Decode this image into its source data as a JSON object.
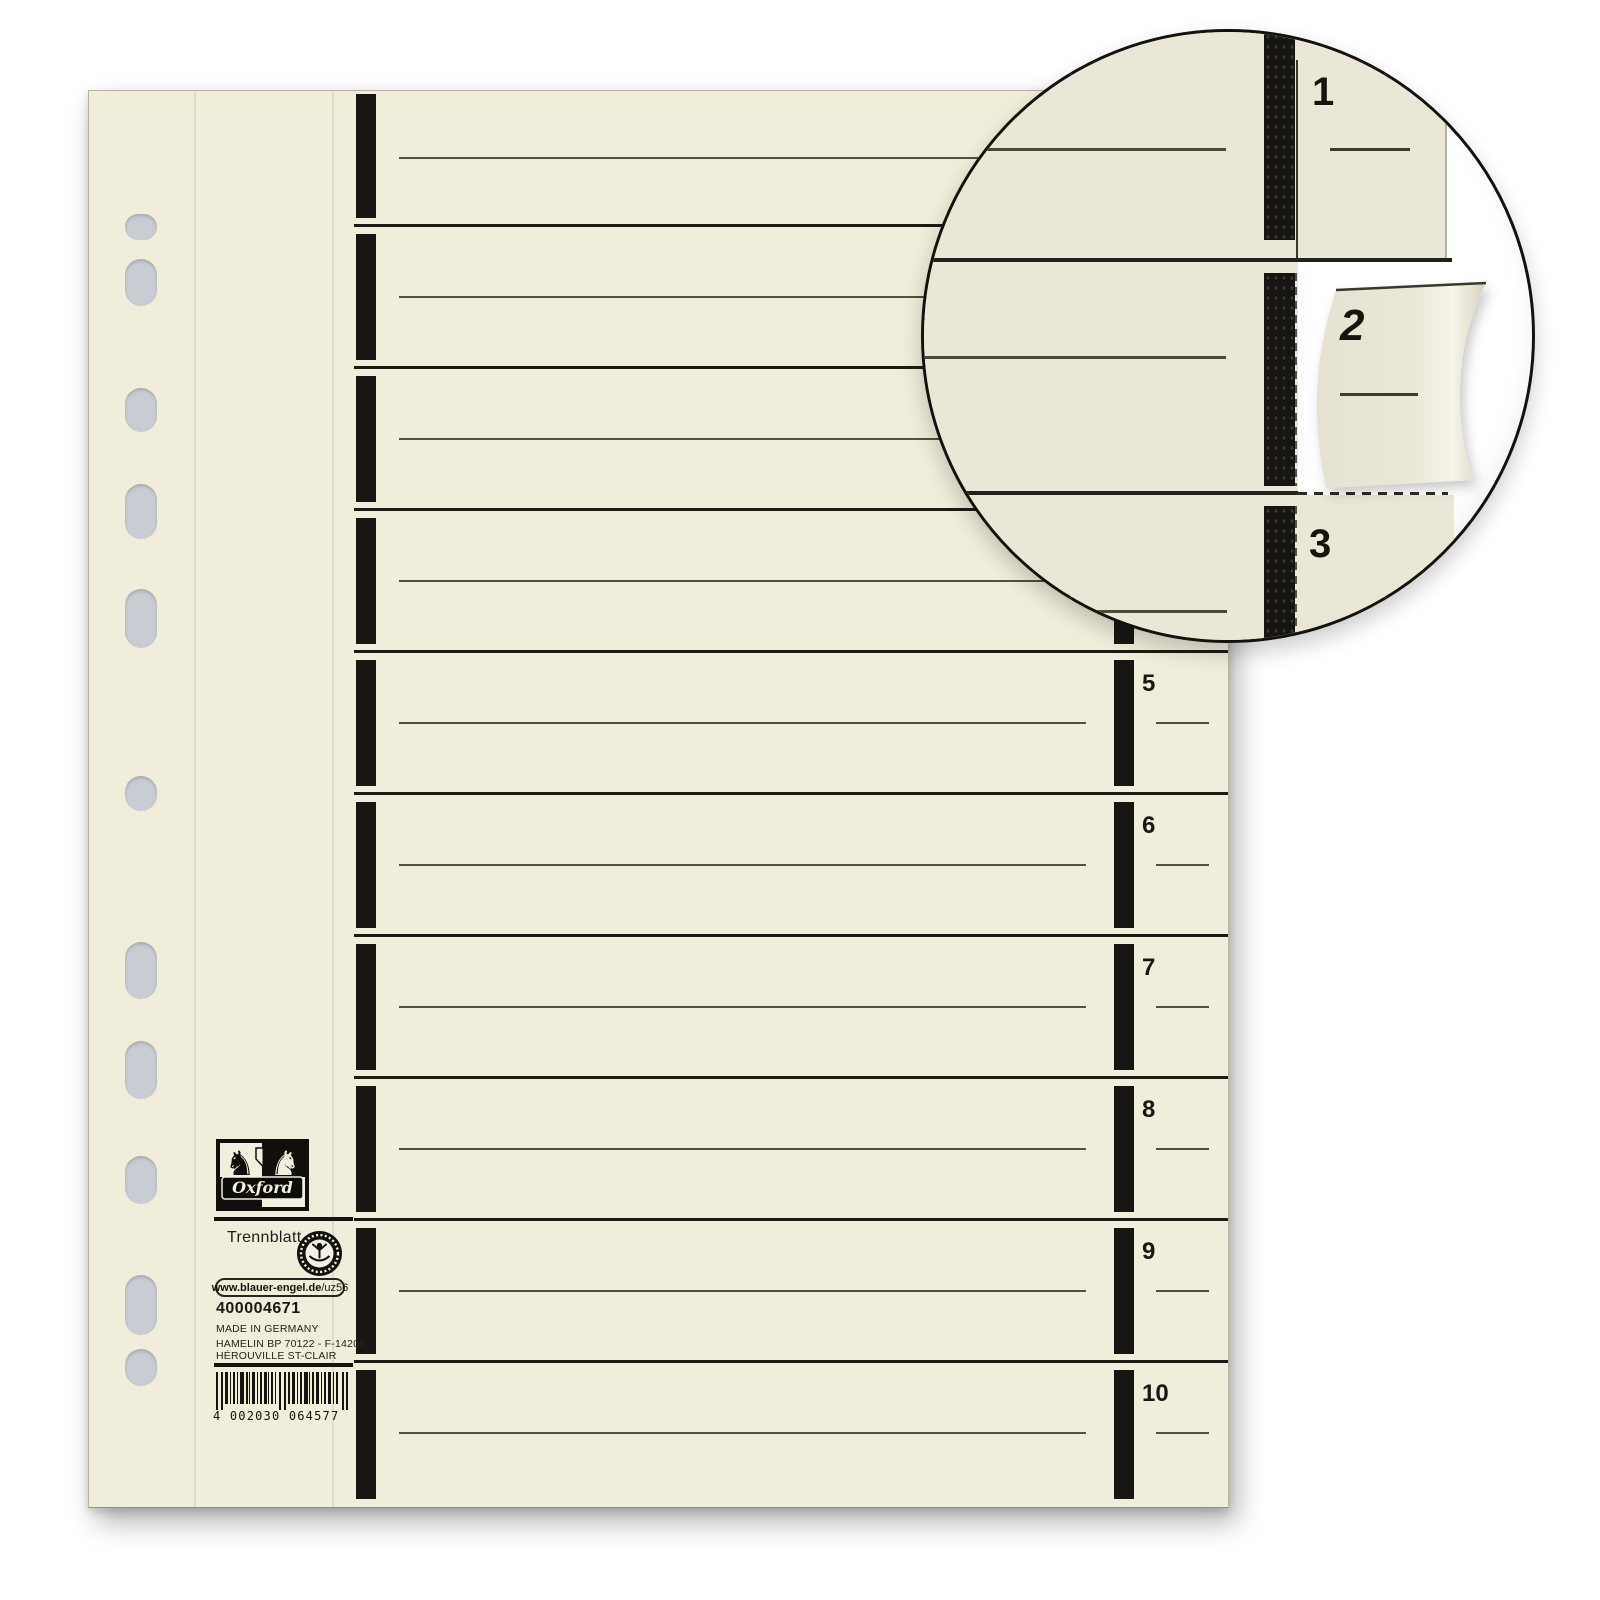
{
  "brand": {
    "name": "Oxford"
  },
  "labels": {
    "product_name": "Trennblatt",
    "article_number": "400004671",
    "made_in": "MADE IN GERMANY",
    "address_line1": "HAMELIN  BP 70122 - F-14204",
    "address_line2": "HÉROUVILLE ST-CLAIR"
  },
  "eco_label": {
    "name": "Blauer Engel",
    "link_bold": "www.blauer-engel.de",
    "link_suffix": "/uz56"
  },
  "barcode": {
    "value": "4002030064577",
    "display": "4 002030 064577"
  },
  "sheet": {
    "tabs": [
      "1",
      "2",
      "3",
      "4",
      "5",
      "6",
      "7",
      "8",
      "9",
      "10"
    ],
    "visible_tab_numbers": [
      "5",
      "6",
      "7",
      "8",
      "9",
      "10"
    ]
  },
  "inset": {
    "tabs": [
      "1",
      "2",
      "3"
    ]
  },
  "colors": {
    "paper": "#f0edda",
    "inset_paper": "#eae7d6",
    "stripe": "#171613",
    "writing_line": "#55503c",
    "boundary_line": "#1c1b13",
    "hole": "#c9ccd3",
    "background": "#ffffff"
  }
}
